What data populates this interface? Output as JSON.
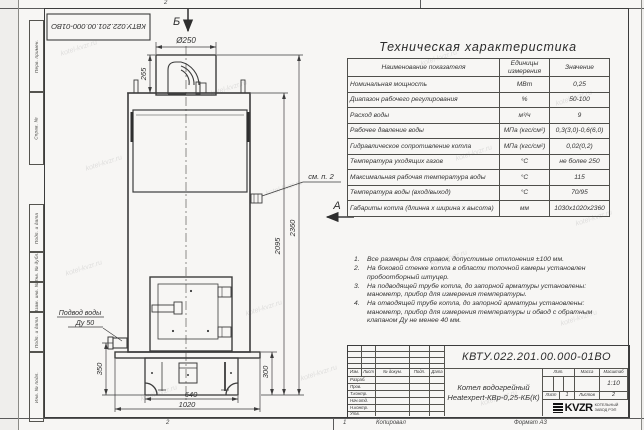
{
  "doc": {
    "number": "КВТУ.022.201.00.000-01ВО",
    "title_line1": "Котел водогрейный",
    "title_line2": "Heatexpert-КВр-0,25-КБ(К)",
    "scale_value": "1:10",
    "sheet_value": "1",
    "sheets_value": "2",
    "copied_label": "Копировал",
    "format_label": "Формат А3",
    "company": "KVZR",
    "company_sub1": "КОТЕЛЬНЫЙ",
    "company_sub2": "ЗАВОД РЭП"
  },
  "frame": {
    "left_labels": [
      "Перв. примен.",
      "Справ. №",
      "Подп. и дата",
      "Инв. № дубл.",
      "Взам. инв. №",
      "Подп. и дата",
      "Инв. № подл."
    ],
    "zone_top": "2",
    "zone_bottom_left": "2",
    "zone_bottom_right": "1"
  },
  "table": {
    "title": "Техническая характеристика",
    "headers": [
      "Наименование показателя",
      "Единицы измерения",
      "Значение"
    ],
    "rows": [
      {
        "name": "Номинальная мощность",
        "unit": "МВт",
        "value": "0,25"
      },
      {
        "name": "Диапазон рабочего регулирования",
        "unit": "%",
        "value": "50-100"
      },
      {
        "name": "Расход воды",
        "unit": "м³/ч",
        "value": "9"
      },
      {
        "name": "Рабочее давление воды",
        "unit": "МПа (кгс/см²)",
        "value": "0,3(3,0)-0,6(6,0)"
      },
      {
        "name": "Гидравлическое сопротивление котла",
        "unit": "МПа (кгс/см²)",
        "value": "0,02(0,2)"
      },
      {
        "name": "Температура уходящих газов",
        "unit": "°С",
        "value": "не более 250"
      },
      {
        "name": "Максимальная рабочая температура воды",
        "unit": "°С",
        "value": "115"
      },
      {
        "name": "Температура воды (вход/выход)",
        "unit": "°С",
        "value": "70/95"
      },
      {
        "name": "Габариты котла (длинна х ширина х высота)",
        "unit": "мм",
        "value": "1030х1020х2360"
      }
    ]
  },
  "notes": [
    {
      "num": "1.",
      "text": "Все размеры для справок, допустимые отклонения ±100 мм."
    },
    {
      "num": "2.",
      "text": "На боковой стенке котла в области топочной камеры установлен пробоотборный штуцер."
    },
    {
      "num": "3.",
      "text": "На подводящей трубе котла, до запорной арматуры установлены: манометр, прибор для измерения температуры."
    },
    {
      "num": "4.",
      "text": "На отводящей трубе котла, до запорной арматуры установлены: манометр, прибор для измерения температуры и обвод с обратным клапаном Ду не менее 40 мм."
    }
  ],
  "titleblock": {
    "cols": [
      "Изм.",
      "Лист",
      "№ докум.",
      "Подп.",
      "Дата"
    ],
    "rows": [
      "Разраб.",
      "Пров.",
      "Т.контр.",
      "Нач.отд.",
      "Н.контр.",
      "Утв."
    ],
    "lit_label": "Лит.",
    "mass_label": "Масса",
    "scale_label": "Масштаб",
    "sheet_label": "Лист",
    "sheets_label": "Листов"
  },
  "drawing": {
    "labels": {
      "view_b": "Б",
      "view_a": "А",
      "see_note": "см. п. 2",
      "water1": "Подвод воды",
      "water2": "Ду 50"
    },
    "dims": {
      "d250": "Ø250",
      "h265": "265",
      "h2095": "2095",
      "h2360": "2360",
      "h350": "350",
      "h300": "300",
      "w640": "640",
      "w1020": "1020"
    }
  },
  "watermark": {
    "text": "kotel-kvzr.ru"
  }
}
